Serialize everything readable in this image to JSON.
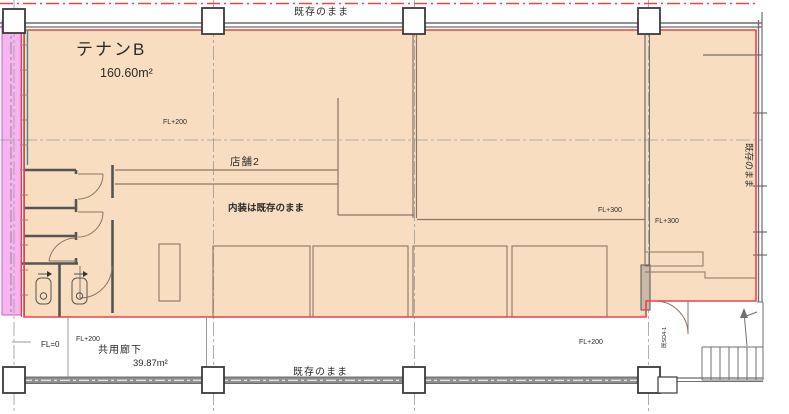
{
  "drawing": {
    "tenant": {
      "name": "テナンB",
      "area": "160.60m²",
      "floor_level": "FL+200",
      "shop_label": "店舗2",
      "interior_note": "内装は既存のまま"
    },
    "annotations": {
      "existing_top": "既存のまま",
      "existing_right": "既存のまま",
      "existing_bottom": "既存のまま",
      "fl_plus_300": "FL+300",
      "fl_plus_200": "FL+200",
      "fl_zero": "FL=0"
    },
    "corridor": {
      "name": "共用廊下",
      "area": "39.87m²",
      "floor_level": "FL+200"
    },
    "door_tag": "既SD4-1",
    "colors": {
      "room_fill": "#f9ddc0",
      "highlight_strip": "#f6b5ef",
      "boundary_red": "#e84545",
      "wall_gray": "#6f6f6f",
      "teal_line": "#2f8fa5"
    }
  }
}
